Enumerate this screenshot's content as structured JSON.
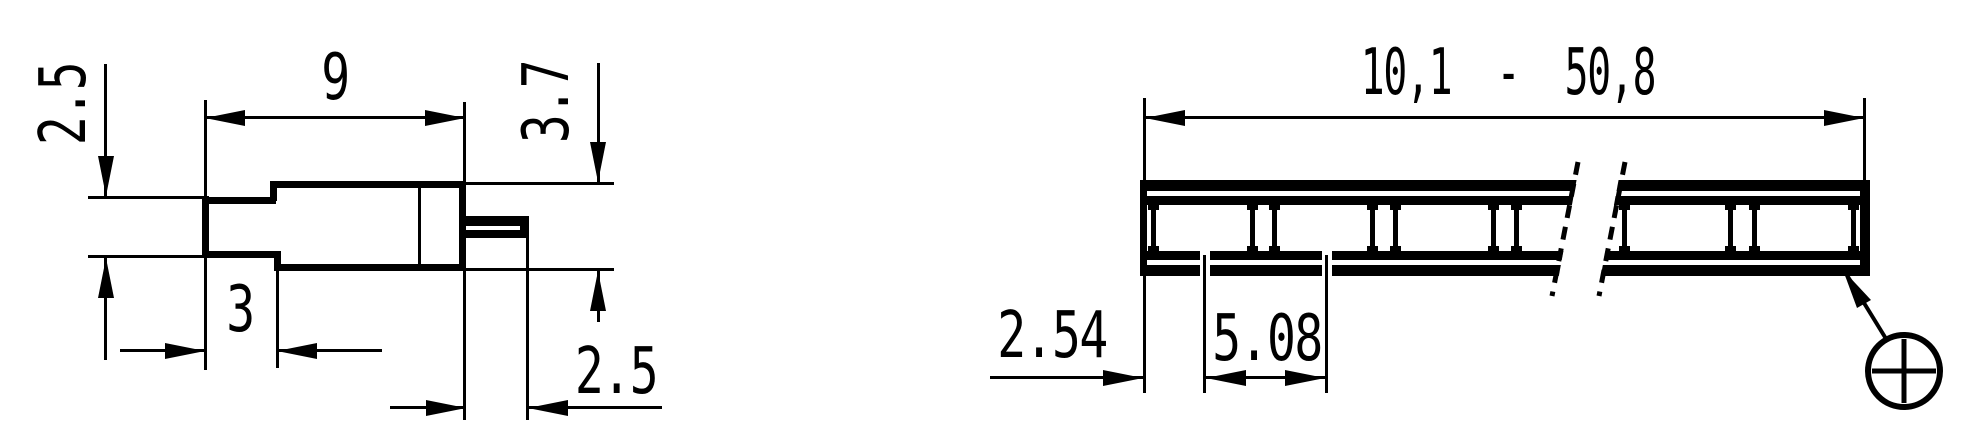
{
  "colors": {
    "ink": "#000000",
    "paper": "#ffffff"
  },
  "left_view": {
    "dim_neck_height": "2.5",
    "dim_body_length": "9",
    "dim_body_height": "3.7",
    "dim_neck_length": "3",
    "dim_pin_length": "2.5"
  },
  "right_view": {
    "dim_total_length": "10,1  -  50,8",
    "dim_end_pitch": "2.54",
    "dim_pitch": "5.08"
  },
  "icons": {
    "position_symbol": "circle-plus-icon"
  }
}
